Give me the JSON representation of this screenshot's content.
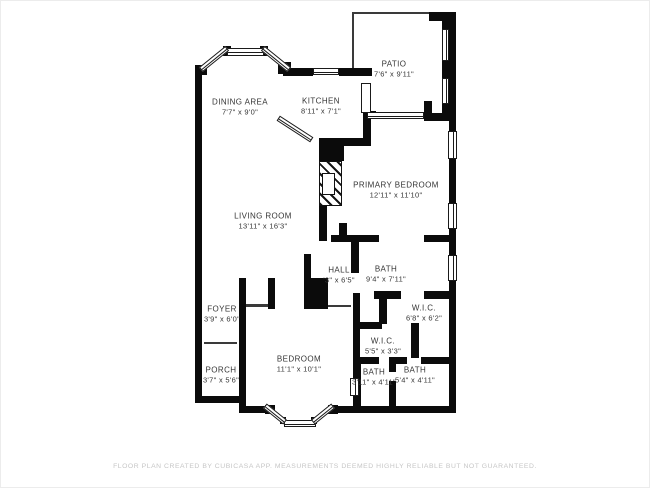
{
  "footer": {
    "text": "FLOOR PLAN CREATED BY CUBICASA APP. MEASUREMENTS DEEMED HIGHLY RELIABLE BUT NOT GUARANTEED."
  },
  "rooms": [
    {
      "name": "PATIO",
      "dims": "7'6\" x 9'11\""
    },
    {
      "name": "DINING AREA",
      "dims": "7'7\" x 9'0\""
    },
    {
      "name": "KITCHEN",
      "dims": "8'11\" x 7'1\""
    },
    {
      "name": "PRIMARY BEDROOM",
      "dims": "12'11\" x 11'10\""
    },
    {
      "name": "LIVING ROOM",
      "dims": "13'11\" x 16'3\""
    },
    {
      "name": "HALL",
      "dims": "'3\" x 6'5\""
    },
    {
      "name": "BATH",
      "dims": "9'4\" x 7'11\""
    },
    {
      "name": "W.I.C.",
      "dims": "6'8\" x 6'2\""
    },
    {
      "name": "W.I.C.",
      "dims": "5'5\" x 3'3\""
    },
    {
      "name": "FOYER",
      "dims": "3'9\" x 6'0\""
    },
    {
      "name": "PORCH",
      "dims": "3'7\" x 5'6\""
    },
    {
      "name": "BEDROOM",
      "dims": "11'1\" x 10'1\""
    },
    {
      "name": "BATH",
      "dims": "3'11\" x 4'11\""
    },
    {
      "name": "BATH",
      "dims": "5'4\" x 4'11\""
    }
  ]
}
